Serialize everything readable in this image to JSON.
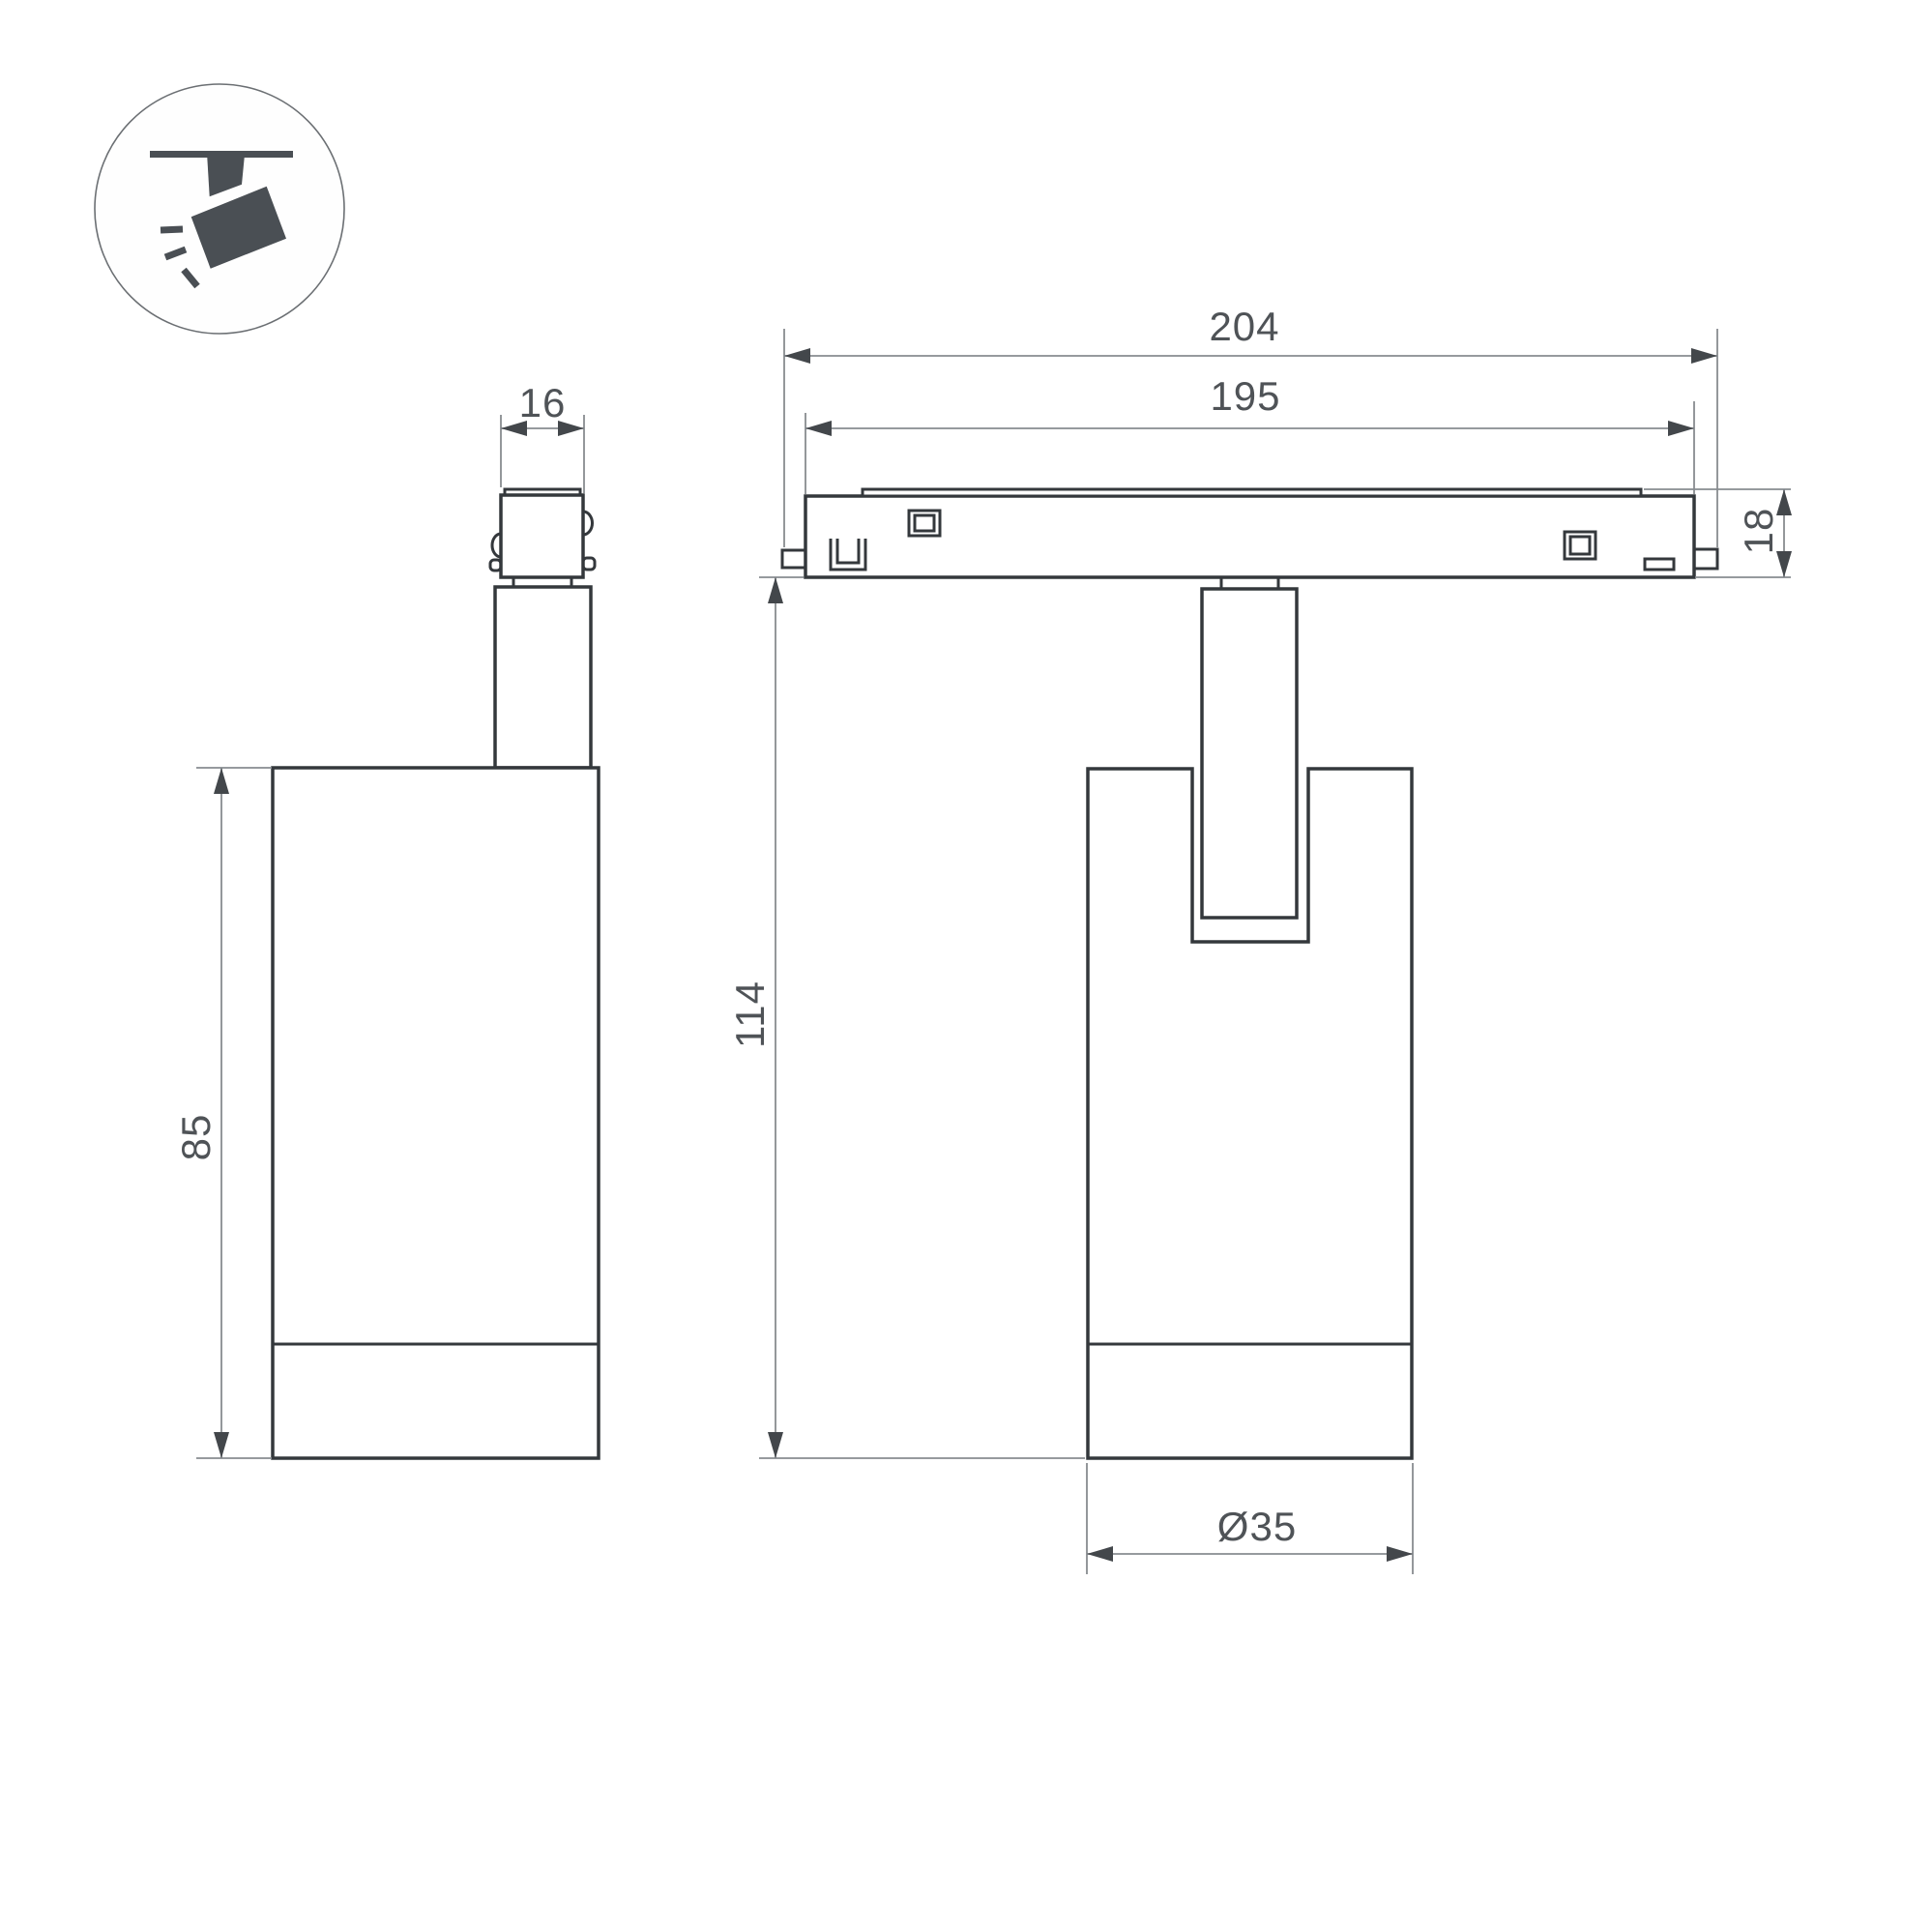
{
  "dimensions": {
    "adapter_width": "16",
    "track_length": "204",
    "track_visible_length": "195",
    "track_height": "18",
    "overall_height": "114",
    "body_height": "85",
    "body_diameter": "Ø35"
  },
  "colors": {
    "background": "#ffffff",
    "outline": "#34383c",
    "dimension_line": "#888c90",
    "arrow": "#43474b",
    "dimension_text": "#4f5357",
    "icon_fill": "#4a4f54",
    "icon_circle_stroke": "#6b6f73"
  }
}
